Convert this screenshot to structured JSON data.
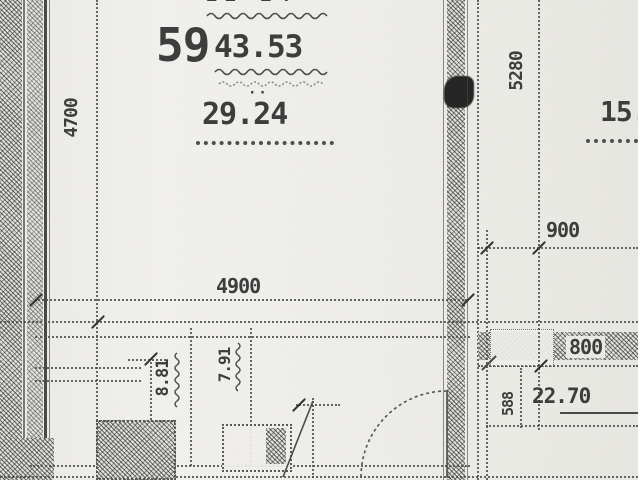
{
  "labels": {
    "top_clipped_digits": "21-24",
    "apartment_number": "59",
    "total_area": "43.53",
    "separator_mark": "··",
    "living_area": "29.24",
    "room_area_right_top": "15.",
    "room_area_right_bottom": "22.70",
    "bath_area_left": "8.81",
    "bath_area_right": "7.91"
  },
  "dimensions": {
    "vertical_left": "4700",
    "vertical_right": "5280",
    "horizontal_main": "4900",
    "right_top_width": "900",
    "right_mid_width": "800",
    "right_small_height": "588"
  },
  "colors": {
    "paper": "#f3f2ee",
    "ink": "#3e3e3e",
    "wall_hatch": "#4c4c4c"
  }
}
